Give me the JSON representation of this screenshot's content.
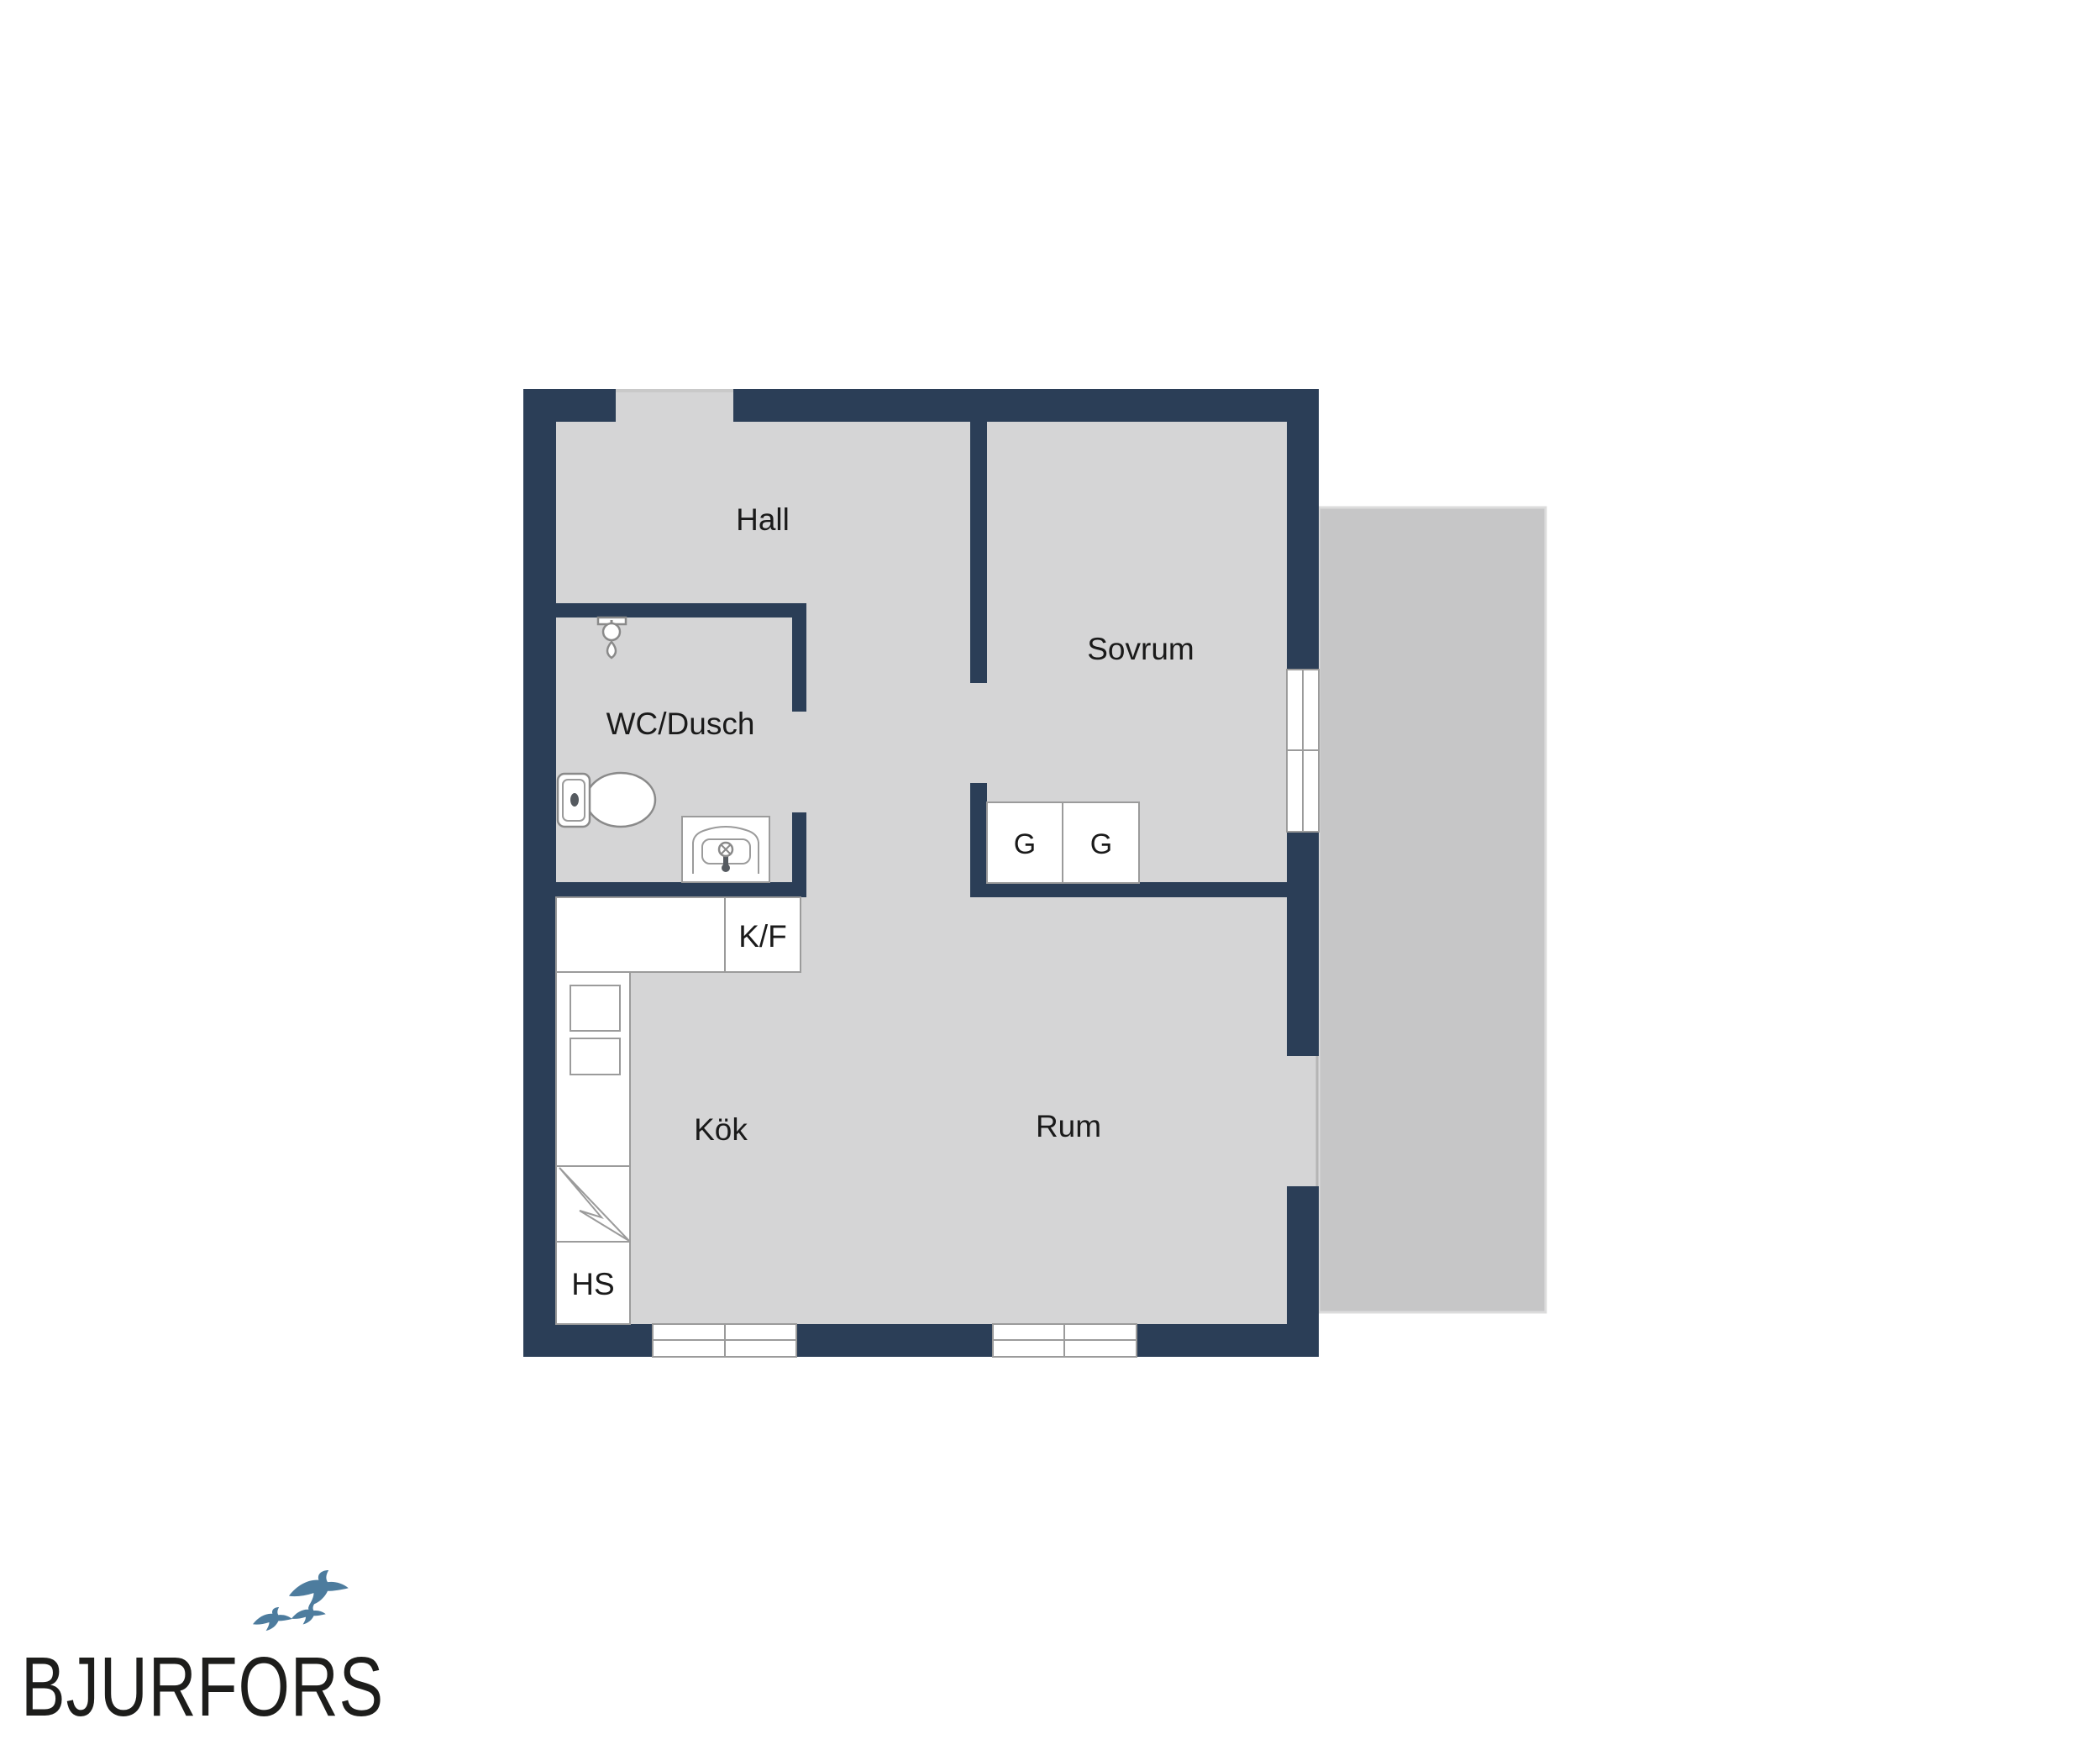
{
  "floorplan": {
    "rooms": {
      "hall": {
        "label": "Hall"
      },
      "sovrum": {
        "label": "Sovrum"
      },
      "wc_dusch": {
        "label": "WC/Dusch"
      },
      "kok": {
        "label": "Kök"
      },
      "rum": {
        "label": "Rum"
      }
    },
    "fixtures": {
      "kf": {
        "label": "K/F"
      },
      "g1": {
        "label": "G"
      },
      "g2": {
        "label": "G"
      },
      "hs": {
        "label": "HS"
      }
    }
  },
  "branding": {
    "logo_text": "BJURFORS"
  },
  "colors": {
    "wall": "#2b3e57",
    "floor": "#d5d5d6",
    "balcony": "#c6c6c7",
    "balcony_edge": "#dcdcdc",
    "thin_stroke": "#9b9b9b",
    "fixture_stroke": "#8a8a8a",
    "fixture_dark": "#555a60",
    "label": "#1a1a1a",
    "bird": "#4d7c9e",
    "logo": "#1d1d1b"
  }
}
